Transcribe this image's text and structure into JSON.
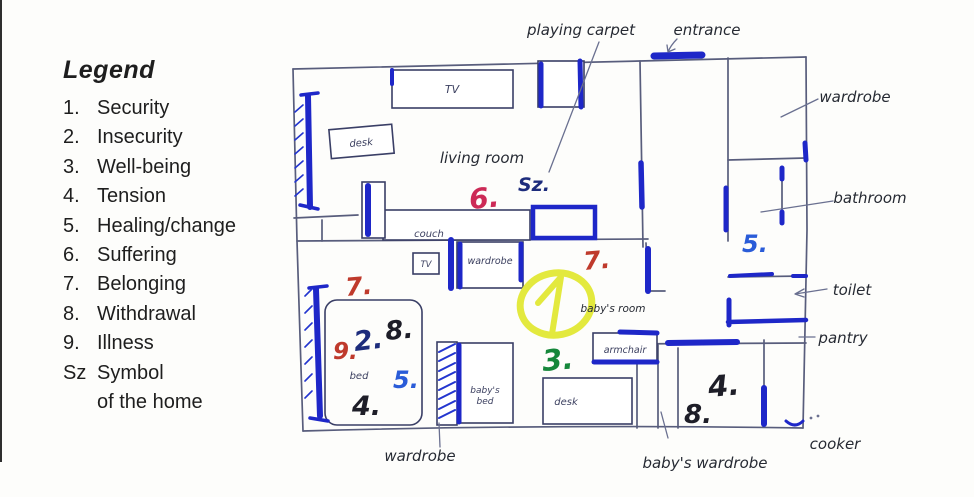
{
  "legend": {
    "title": "Legend",
    "items": [
      {
        "num": "1.",
        "label": "Security"
      },
      {
        "num": "2.",
        "label": "Insecurity"
      },
      {
        "num": "3.",
        "label": "Well-being"
      },
      {
        "num": "4.",
        "label": "Tension"
      },
      {
        "num": "5.",
        "label": "Healing/change"
      },
      {
        "num": "6.",
        "label": "Suffering"
      },
      {
        "num": "7.",
        "label": "Belonging"
      },
      {
        "num": "8.",
        "label": "Withdrawal"
      },
      {
        "num": "9.",
        "label": "Illness"
      },
      {
        "num": "Sz",
        "label": "Symbol"
      },
      {
        "num": "",
        "label": "of the home"
      }
    ]
  },
  "plan": {
    "outside_labels": {
      "playing_carpet": "playing carpet",
      "entrance": "entrance",
      "wardrobe_right": "wardrobe",
      "bathroom": "bathroom",
      "toilet": "toilet",
      "pantry": "pantry",
      "cooker": "cooker",
      "babys_wardrobe": "baby's wardrobe",
      "wardrobe_bottom": "wardrobe"
    },
    "room_labels": {
      "living_room": "living room",
      "babys_room": "baby's room"
    },
    "furniture_labels": {
      "tv_living": "TV",
      "desk_living": "desk",
      "couch": "couch",
      "tv_bedroom": "TV",
      "wardrobe_box": "wardrobe",
      "bed": "bed",
      "babys_bed_line1": "baby's",
      "babys_bed_line2": "bed",
      "desk_babys": "desk",
      "armchair": "armchair"
    },
    "annotations": [
      {
        "id": "living-room-6",
        "label": "6.",
        "color": "crimson"
      },
      {
        "id": "living-room-sz",
        "label": "Sz.",
        "color": "navy"
      },
      {
        "id": "bedroom-7",
        "label": "7.",
        "color": "red"
      },
      {
        "id": "bedroom-9",
        "label": "9.",
        "color": "red"
      },
      {
        "id": "bedroom-2",
        "label": "2.",
        "color": "navy"
      },
      {
        "id": "bedroom-8",
        "label": "8.",
        "color": "black"
      },
      {
        "id": "bedroom-5",
        "label": "5.",
        "color": "blue"
      },
      {
        "id": "bedroom-4",
        "label": "4.",
        "color": "black"
      },
      {
        "id": "babys-room-7",
        "label": "7.",
        "color": "red"
      },
      {
        "id": "babys-room-1-circled",
        "label": "1",
        "color": "yellow"
      },
      {
        "id": "babys-room-3",
        "label": "3.",
        "color": "green"
      },
      {
        "id": "bathroom-5",
        "label": "5.",
        "color": "blue"
      },
      {
        "id": "kitchen-4",
        "label": "4.",
        "color": "black"
      },
      {
        "id": "kitchen-8",
        "label": "8.",
        "color": "black"
      }
    ],
    "colors": {
      "crimson": "#cc2a56",
      "red": "#bf3a2c",
      "navy": "#1d2c7c",
      "blue": "#2a5cd8",
      "green": "#15873a",
      "black": "#1e1e28",
      "yellow": "#e3e93e",
      "ink_blue": "#1e27c8",
      "wall_gray": "#585d7c",
      "leader_gray": "#6a7090"
    }
  }
}
